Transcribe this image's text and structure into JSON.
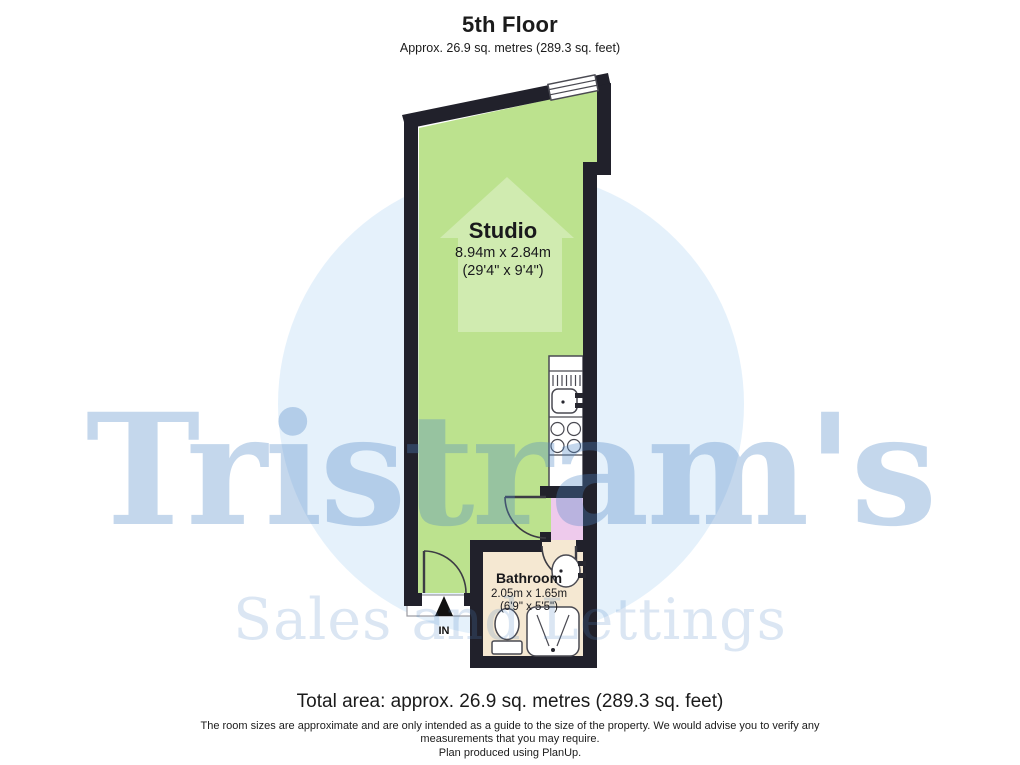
{
  "header": {
    "title": "5th Floor",
    "subtitle": "Approx. 26.9 sq. metres (289.3 sq. feet)"
  },
  "floorplan": {
    "rooms": {
      "studio": {
        "name": "Studio",
        "size_metric": "8.94m x 2.84m",
        "size_imperial": "(29'4\" x 9'4\")"
      },
      "bathroom": {
        "name": "Bathroom",
        "size_metric": "2.05m x 1.65m",
        "size_imperial": "(6'9\" x 5'5\")"
      }
    },
    "entrance_label": "IN",
    "features": [
      "window",
      "kitchen-sink",
      "hob",
      "bathroom-sink",
      "toilet",
      "shower"
    ]
  },
  "watermark": {
    "brand": "Tristram's",
    "tagline": "Sales and Lettings"
  },
  "footer": {
    "total_area": "Total area: approx. 26.9 sq. metres (289.3 sq. feet)",
    "disclaimer": "The room sizes are approximate and are only intended as a guide to the size of the property. We would advise you to verify any measurements that you may require.",
    "credit": "Plan produced using PlanUp."
  },
  "colors": {
    "wall": "#21212b",
    "studio_green": "#bce28e",
    "hall_pink": "#eecaec",
    "bathroom_beige": "#f5e8d2",
    "watermark_blue": "#4f87c6",
    "watermark_circle": "#cfe6f8",
    "fixture_outline": "#4a4a52"
  }
}
